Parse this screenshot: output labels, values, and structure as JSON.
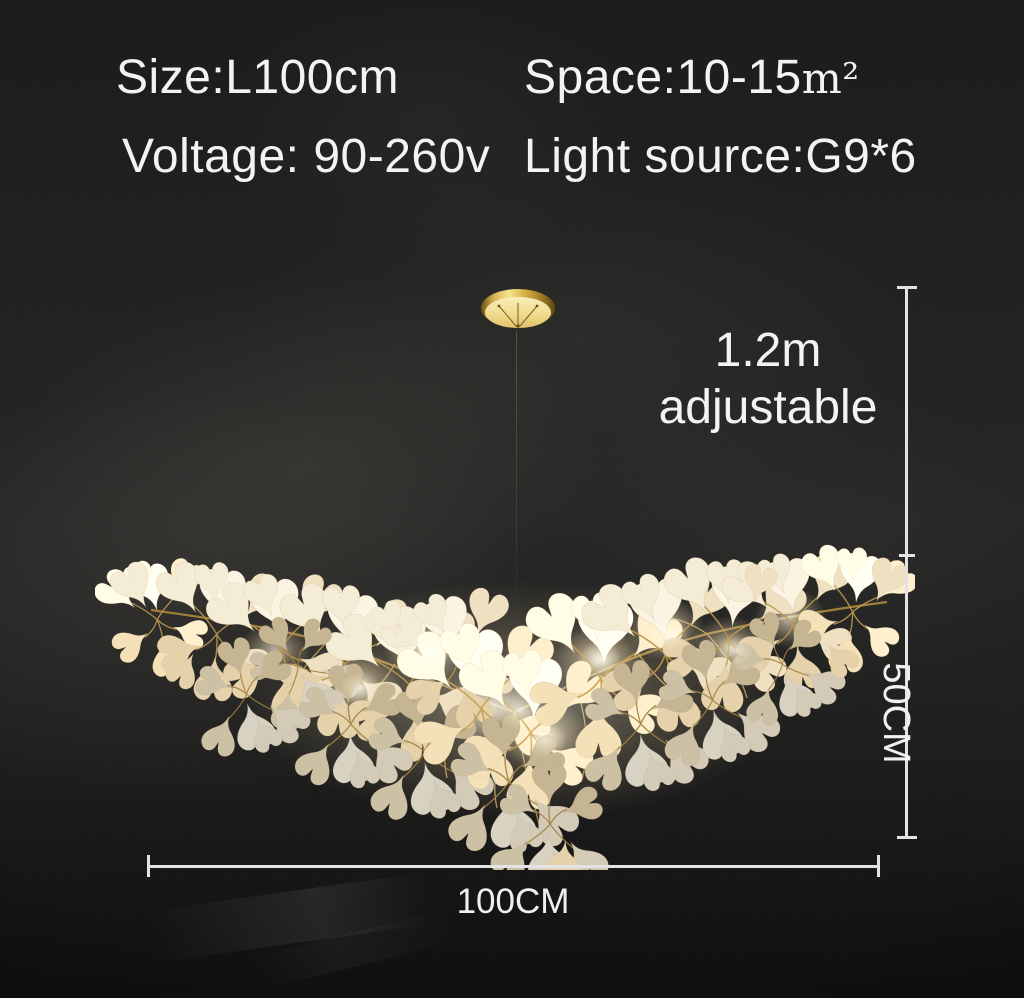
{
  "specs": {
    "size": "Size:L100cm",
    "space_value": "Space:10-15",
    "space_unit": "m²",
    "voltage": "Voltage: 90-260v",
    "light_source": "Light source:G9*6"
  },
  "dimensions": {
    "drop_line1": "1.2m",
    "drop_line2": "adjustable",
    "height": "50CM",
    "width": "100CM"
  },
  "colors": {
    "background": "#1a1a19",
    "text": "#f3f3f3",
    "dimension_line": "#e3e3e3",
    "gold": "#c9a44e",
    "leaf_cream": "#f3e8cf",
    "lamp_glow": "#ffeec2"
  }
}
